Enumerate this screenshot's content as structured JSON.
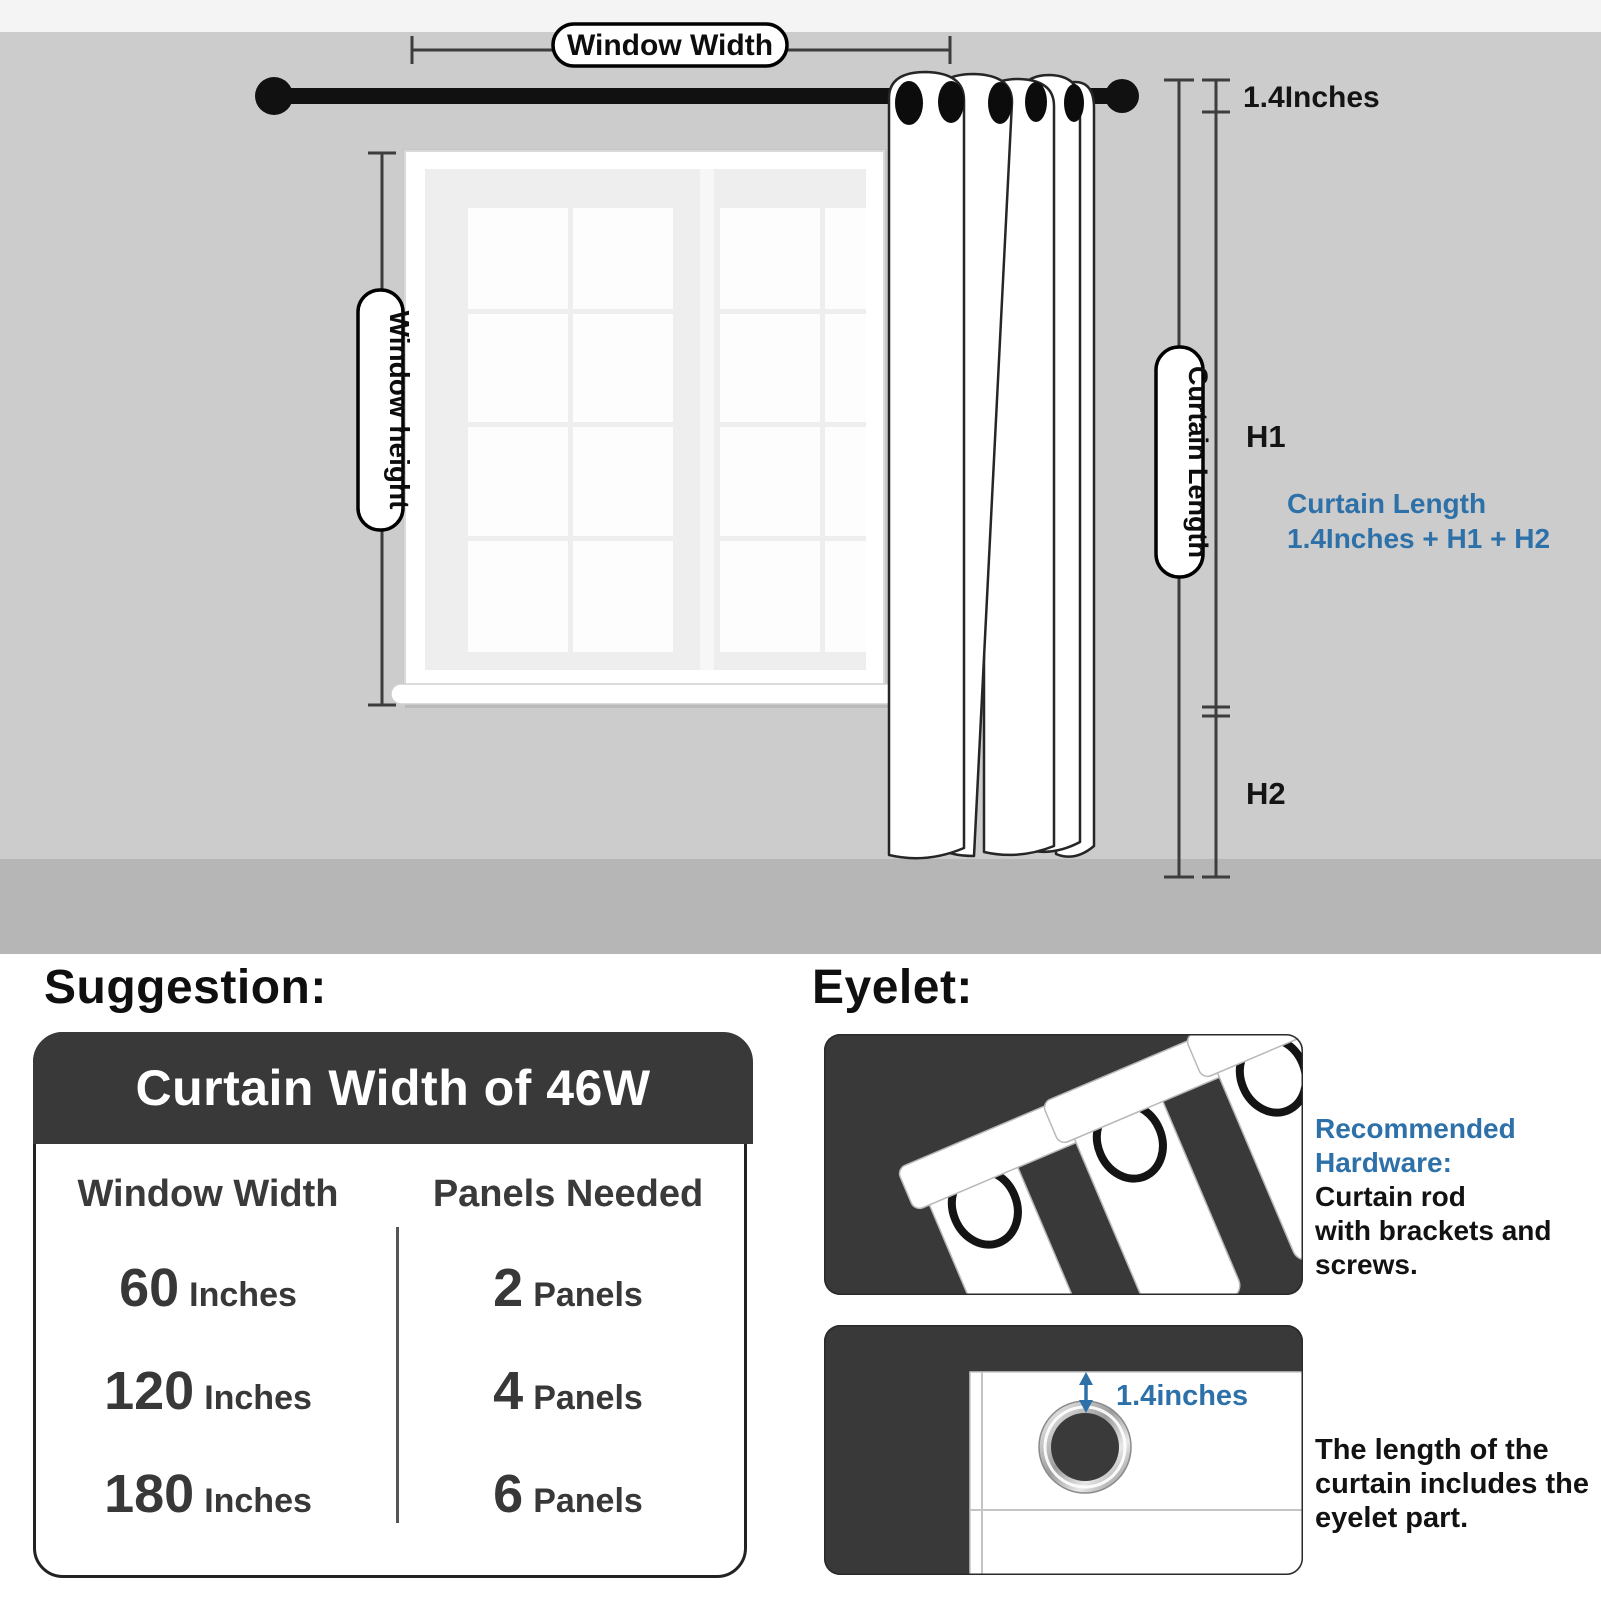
{
  "colors": {
    "accent_blue": "#2e71a9",
    "panel_dark": "#393939",
    "wall_gray": "#cccccc",
    "floor_gray": "#b6b6b6",
    "rod_black": "#111111"
  },
  "scene": {
    "window_width_label": "Window Width",
    "window_height_label": "Window height",
    "rod_offset_label": "1.4Inches",
    "h1_label": "H1",
    "h2_label": "H2",
    "curtain_length_pill": "Curtain Length",
    "formula_line1": "Curtain Length",
    "formula_line2": "1.4Inches + H1 + H2"
  },
  "suggestion": {
    "heading": "Suggestion:",
    "card_title": "Curtain Width of 46W",
    "col1_header": "Window Width",
    "col2_header": "Panels Needed",
    "rows": [
      {
        "width_value": "60",
        "width_unit": "Inches",
        "panels_value": "2",
        "panels_unit": "Panels"
      },
      {
        "width_value": "120",
        "width_unit": "Inches",
        "panels_value": "4",
        "panels_unit": "Panels"
      },
      {
        "width_value": "180",
        "width_unit": "Inches",
        "panels_value": "6",
        "panels_unit": "Panels"
      }
    ]
  },
  "eyelet": {
    "heading": "Eyelet:",
    "hardware_line1": "Recommended",
    "hardware_line2": "Hardware:",
    "hardware_line3": "Curtain rod",
    "hardware_line4": "with brackets and",
    "hardware_line5": "screws.",
    "eyelet_measure_label": "1.4inches",
    "note_line1": "The length of the",
    "note_line2": "curtain includes the",
    "note_line3": "eyelet part."
  }
}
